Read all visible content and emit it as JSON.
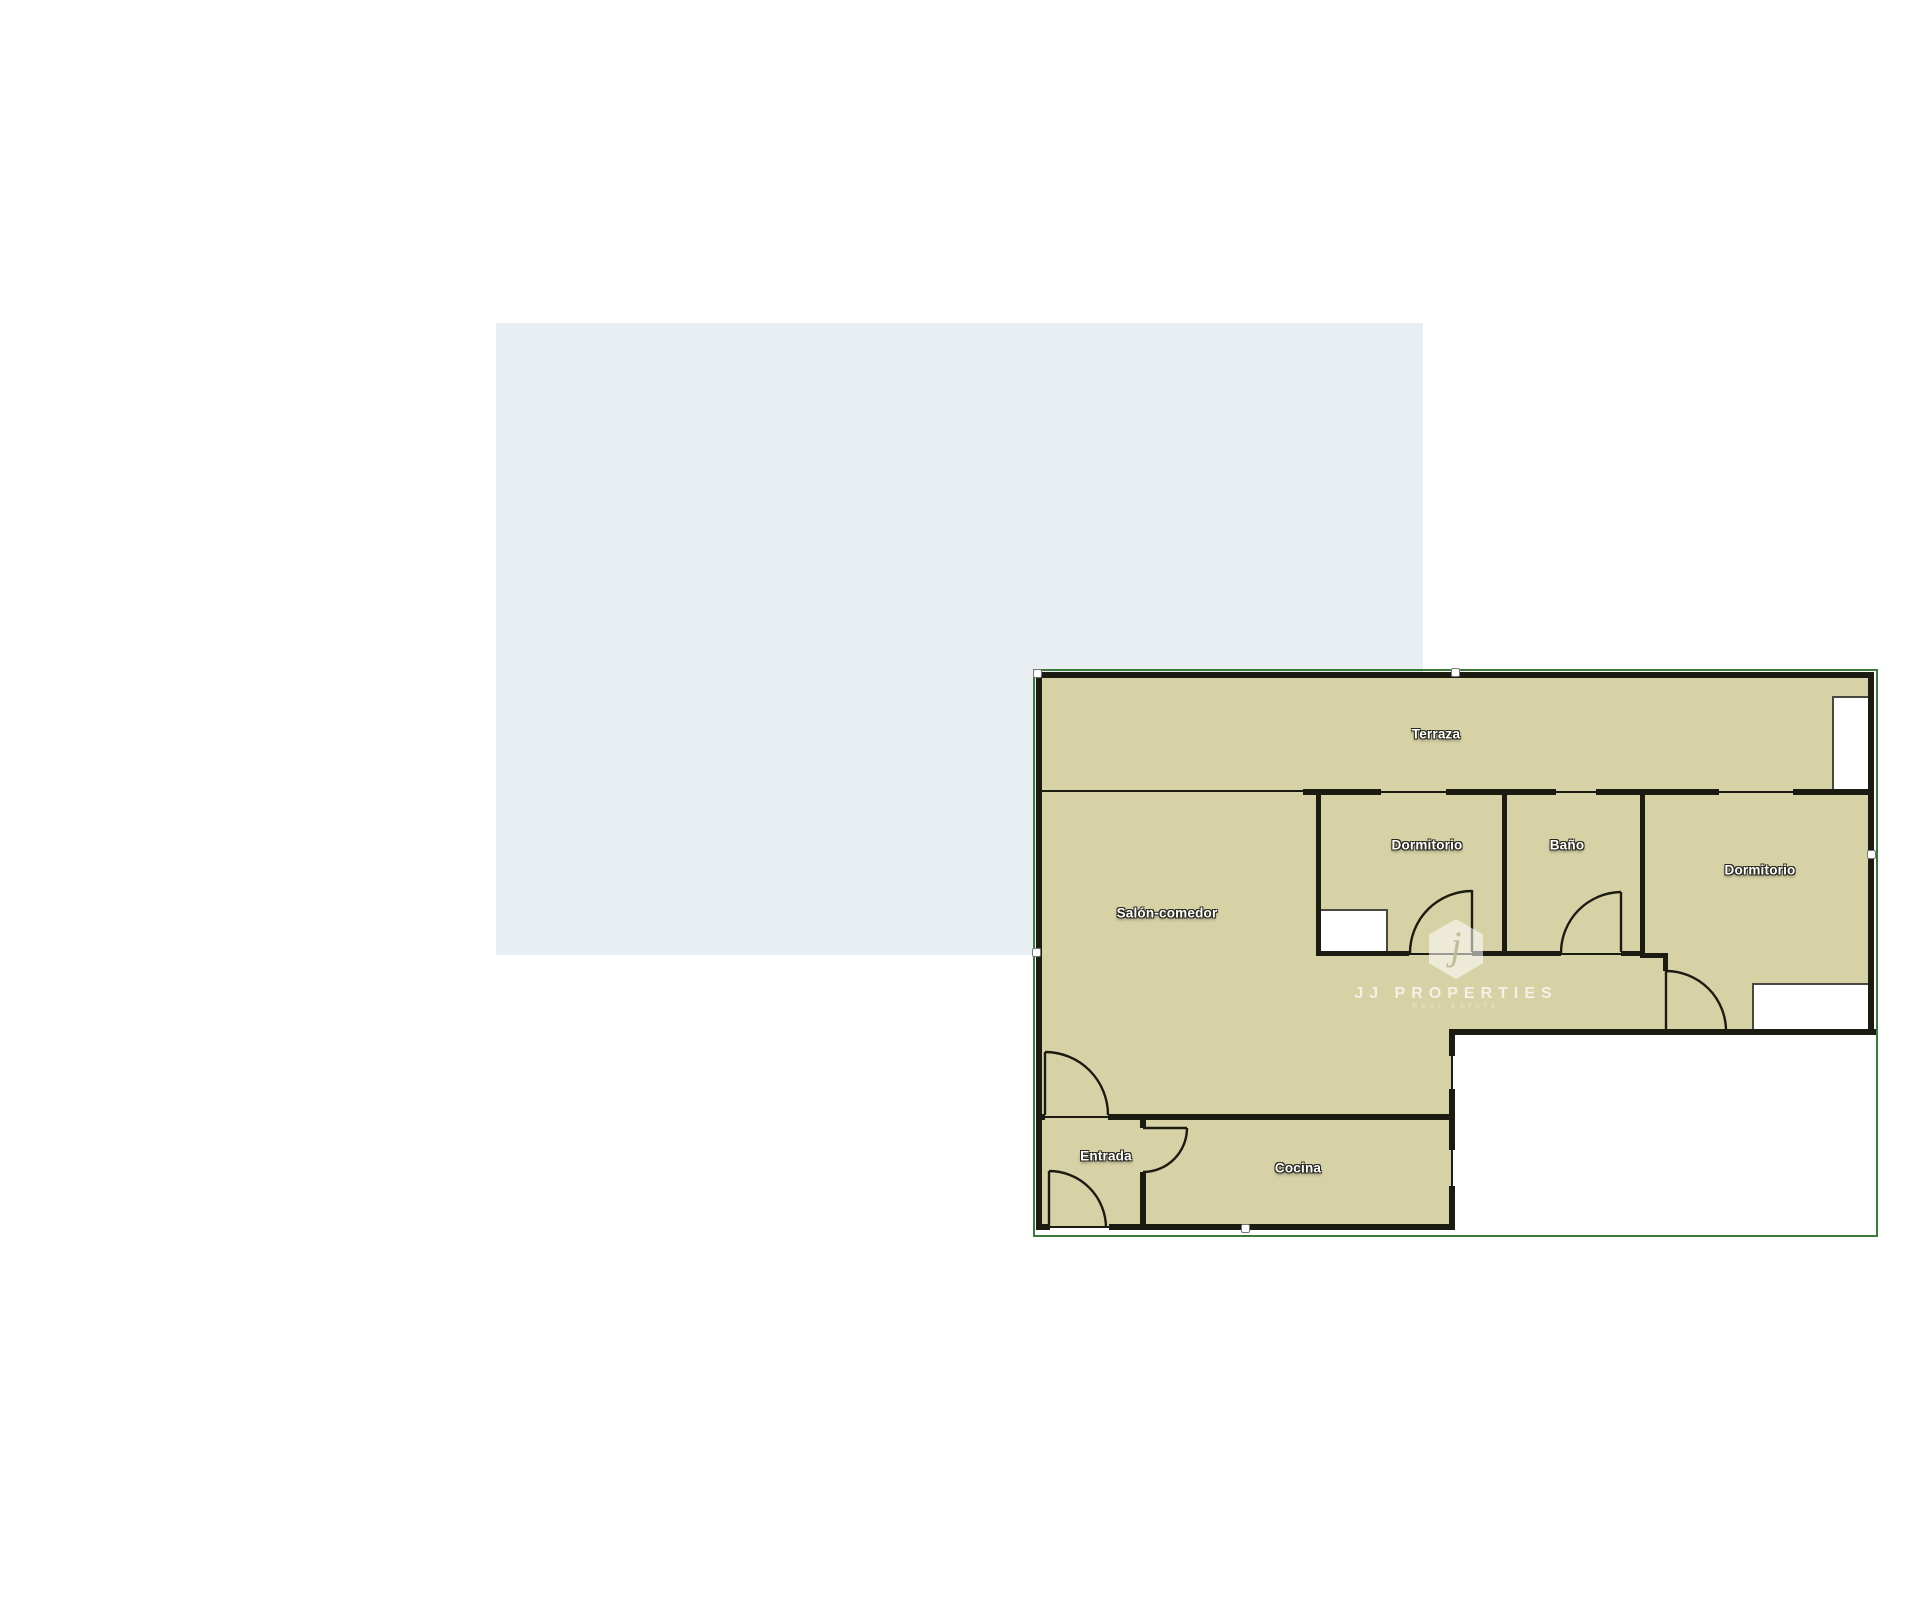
{
  "colors": {
    "panel": "#e9eef2",
    "floor": "#d7d2a6",
    "wall": "#1b1b12",
    "outline": "#3c7a3c",
    "closet_border": "#49493f",
    "label": "#ffffff"
  },
  "rooms": {
    "terraza": "Terraza",
    "dormitorio_1": "Dormitorio",
    "bano": "Baño",
    "dormitorio_2": "Dormitorio",
    "salon": "Salón-comedor",
    "entrada": "Entrada",
    "cocina": "Cocina"
  },
  "watermark": {
    "logo_letter": "j",
    "line1": "JJ PROPERTIES",
    "line2": "REAL ESTATE"
  }
}
